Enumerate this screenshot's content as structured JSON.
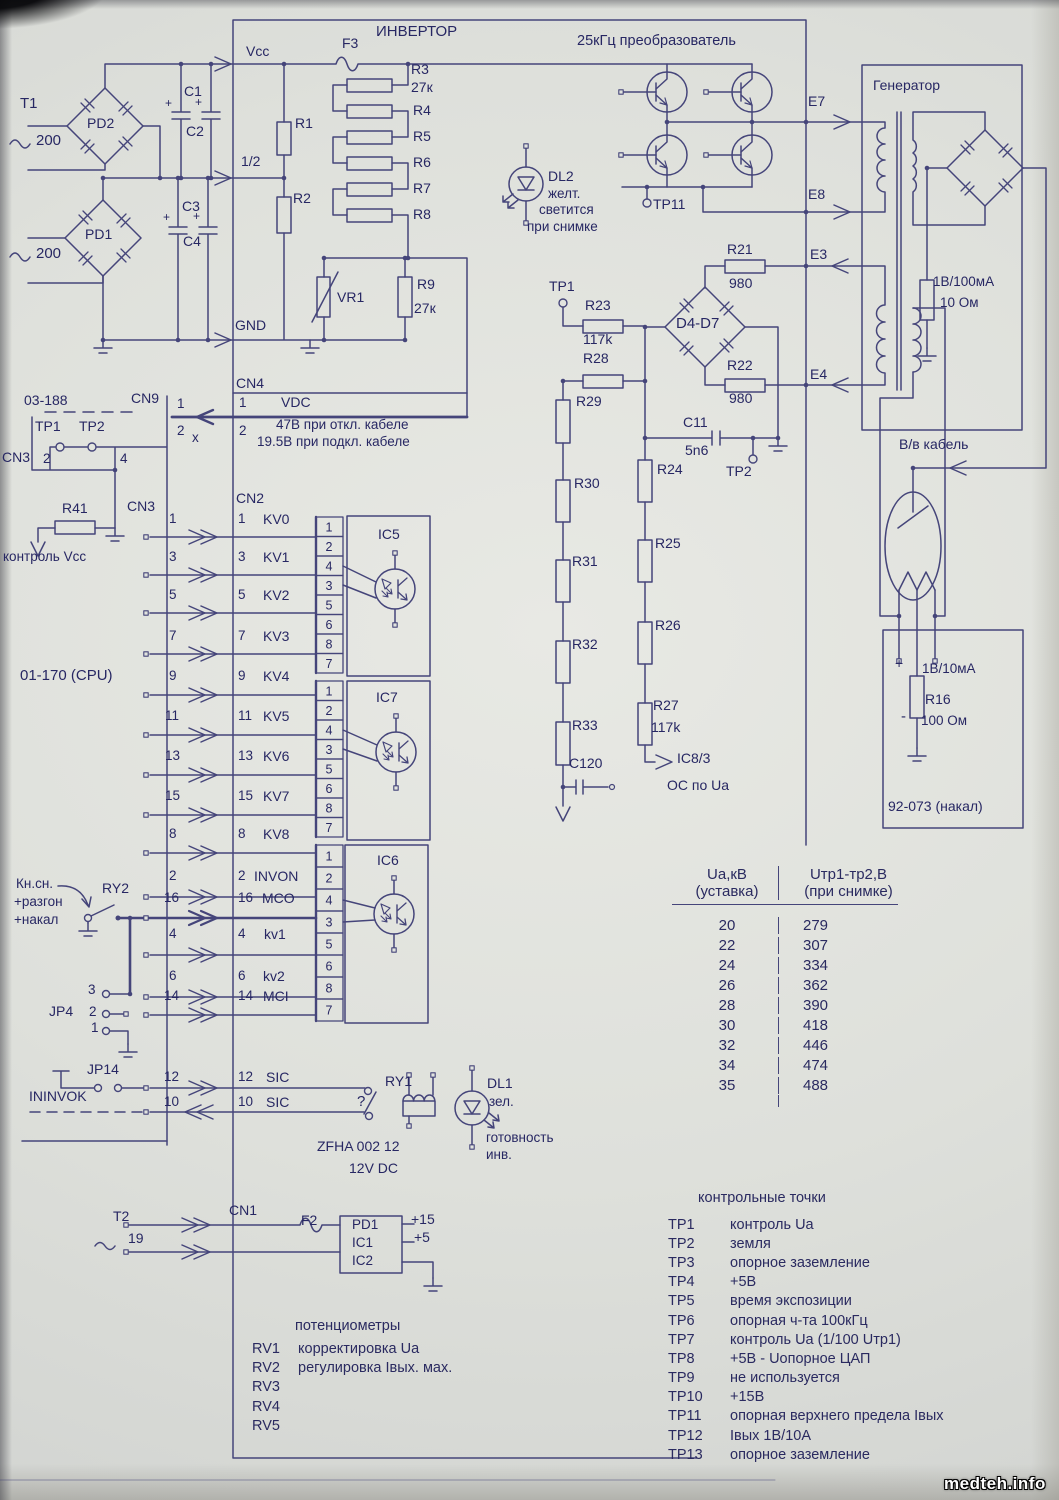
{
  "watermark": "medteh.info",
  "colors": {
    "ink": "#45457a",
    "text": "#272763",
    "paper": "#dee0db"
  },
  "opto_pin_sequence": [
    "1",
    "2",
    "4",
    "3",
    "5",
    "6",
    "8",
    "7"
  ],
  "table": {
    "h1a": "Ua,кВ",
    "h1b": "(уставка)",
    "h2a": "Uтр1-тр2,В",
    "h2b": "(при снимке)",
    "rows": [
      [
        "20",
        "279"
      ],
      [
        "22",
        "307"
      ],
      [
        "24",
        "334"
      ],
      [
        "26",
        "362"
      ],
      [
        "28",
        "390"
      ],
      [
        "30",
        "418"
      ],
      [
        "32",
        "446"
      ],
      [
        "34",
        "474"
      ],
      [
        "35",
        "488"
      ]
    ]
  },
  "test_points": {
    "title": "контрольные точки",
    "items": [
      [
        "TP1",
        "контроль Ua"
      ],
      [
        "TP2",
        "земля"
      ],
      [
        "TP3",
        "опорное заземление"
      ],
      [
        "TP4",
        "+5В"
      ],
      [
        "TP5",
        "время экспозиции"
      ],
      [
        "TP6",
        "опорная ч-та 100кГц"
      ],
      [
        "TP7",
        "контроль Ua (1/100 Uтр1)"
      ],
      [
        "TP8",
        "+5В - Uопорное ЦАП"
      ],
      [
        "TP9",
        "не используется"
      ],
      [
        "TP10",
        "+15В"
      ],
      [
        "TP11",
        "опорная верхнего предела Iвых"
      ],
      [
        "TP12",
        "Iвых 1В/10А"
      ],
      [
        "TP13",
        "опорное заземление"
      ]
    ]
  },
  "potentiometers": {
    "title": "потенциометры",
    "items": [
      [
        "RV1",
        "корректировка Ua"
      ],
      [
        "RV2",
        "регулировка Iвых. мах."
      ],
      [
        "RV3",
        ""
      ],
      [
        "RV4",
        ""
      ],
      [
        "RV5",
        ""
      ]
    ]
  },
  "labels": [
    {
      "n": "t1-label",
      "t": "T1",
      "x": 20,
      "y": 96,
      "s": 15
    },
    {
      "n": "ac1-value",
      "t": "200",
      "x": 36,
      "y": 133,
      "s": 15
    },
    {
      "n": "ac2-value",
      "t": "200",
      "x": 36,
      "y": 246,
      "s": 15
    },
    {
      "n": "pd2-label",
      "t": "PD2",
      "x": 87,
      "y": 116,
      "s": 14
    },
    {
      "n": "pd1-label",
      "t": "PD1",
      "x": 85,
      "y": 227,
      "s": 14
    },
    {
      "n": "c1-label",
      "t": "C1",
      "x": 184,
      "y": 84,
      "s": 14
    },
    {
      "n": "c2-label",
      "t": "C2",
      "x": 186,
      "y": 124,
      "s": 14
    },
    {
      "n": "c3-label",
      "t": "C3",
      "x": 182,
      "y": 199,
      "s": 14
    },
    {
      "n": "c4-label",
      "t": "C4",
      "x": 183,
      "y": 234,
      "s": 14
    },
    {
      "n": "c1-plus",
      "t": "+",
      "x": 165,
      "y": 97,
      "s": 12
    },
    {
      "n": "c2-plus",
      "t": "+",
      "x": 195,
      "y": 96,
      "s": 12
    },
    {
      "n": "c3-plus",
      "t": "+",
      "x": 163,
      "y": 211,
      "s": 12
    },
    {
      "n": "c4-plus",
      "t": "+",
      "x": 193,
      "y": 210,
      "s": 12
    },
    {
      "n": "vcc-label",
      "t": "Vcc",
      "x": 246,
      "y": 44,
      "s": 14
    },
    {
      "n": "half-label",
      "t": "1/2",
      "x": 241,
      "y": 154,
      "s": 14
    },
    {
      "n": "gnd-label",
      "t": "GND",
      "x": 235,
      "y": 318,
      "s": 14
    },
    {
      "n": "inverter-title",
      "t": "ИНВЕРТОР",
      "x": 376,
      "y": 24,
      "s": 15
    },
    {
      "n": "f3-label",
      "t": "F3",
      "x": 342,
      "y": 36,
      "s": 14
    },
    {
      "n": "r3-label",
      "t": "R3",
      "x": 411,
      "y": 62,
      "s": 14
    },
    {
      "n": "r3-value",
      "t": "27к",
      "x": 411,
      "y": 80,
      "s": 14
    },
    {
      "n": "r4-label",
      "t": "R4",
      "x": 413,
      "y": 103,
      "s": 14
    },
    {
      "n": "r5-label",
      "t": "R5",
      "x": 413,
      "y": 129,
      "s": 14
    },
    {
      "n": "r6-label",
      "t": "R6",
      "x": 413,
      "y": 155,
      "s": 14
    },
    {
      "n": "r7-label",
      "t": "R7",
      "x": 413,
      "y": 181,
      "s": 14
    },
    {
      "n": "r8-label",
      "t": "R8",
      "x": 413,
      "y": 207,
      "s": 14
    },
    {
      "n": "r1-label",
      "t": "R1",
      "x": 295,
      "y": 116,
      "s": 14
    },
    {
      "n": "r2-label",
      "t": "R2",
      "x": 293,
      "y": 191,
      "s": 14
    },
    {
      "n": "vr1-label",
      "t": "VR1",
      "x": 337,
      "y": 290,
      "s": 14
    },
    {
      "n": "r9-label",
      "t": "R9",
      "x": 417,
      "y": 277,
      "s": 14
    },
    {
      "n": "r9-value",
      "t": "27к",
      "x": 414,
      "y": 301,
      "s": 14
    },
    {
      "n": "dl2-label",
      "t": "DL2",
      "x": 548,
      "y": 169,
      "s": 14
    },
    {
      "n": "dl2-color",
      "t": "желт.",
      "x": 548,
      "y": 187
    },
    {
      "n": "dl2-note-1",
      "t": "светится",
      "x": 539,
      "y": 203
    },
    {
      "n": "dl2-note-2",
      "t": "при снимке",
      "x": 527,
      "y": 220
    },
    {
      "n": "converter-title",
      "t": "25кГц преобразователь",
      "x": 577,
      "y": 34,
      "s": 14.5
    },
    {
      "n": "tp11-label",
      "t": "TP11",
      "x": 653,
      "y": 197,
      "s": 14
    },
    {
      "n": "e7-label",
      "t": "E7",
      "x": 808,
      "y": 94,
      "s": 14
    },
    {
      "n": "e8-label",
      "t": "E8",
      "x": 808,
      "y": 187,
      "s": 14
    },
    {
      "n": "e3-label",
      "t": "E3",
      "x": 810,
      "y": 247,
      "s": 14
    },
    {
      "n": "e4-label",
      "t": "E4",
      "x": 810,
      "y": 367,
      "s": 14
    },
    {
      "n": "generator-title",
      "t": "Генератор",
      "x": 873,
      "y": 78,
      "s": 14
    },
    {
      "n": "r21-label",
      "t": "R21",
      "x": 727,
      "y": 242,
      "s": 14
    },
    {
      "n": "r21-value",
      "t": "980",
      "x": 729,
      "y": 276,
      "s": 14
    },
    {
      "n": "r22-label",
      "t": "R22",
      "x": 727,
      "y": 358,
      "s": 14
    },
    {
      "n": "r22-value",
      "t": "980",
      "x": 729,
      "y": 391,
      "s": 14
    },
    {
      "n": "d4d7-label",
      "t": "D4-D7",
      "x": 676,
      "y": 316,
      "s": 15
    },
    {
      "n": "tp1-mid-label",
      "t": "TP1",
      "x": 549,
      "y": 279,
      "s": 14
    },
    {
      "n": "r23-label",
      "t": "R23",
      "x": 585,
      "y": 298,
      "s": 14
    },
    {
      "n": "r23-value",
      "t": "117k",
      "x": 583,
      "y": 332,
      "s": 14
    },
    {
      "n": "r28-label",
      "t": "R28",
      "x": 583,
      "y": 351,
      "s": 14
    },
    {
      "n": "c11-label",
      "t": "C11",
      "x": 683,
      "y": 415,
      "s": 14
    },
    {
      "n": "c11-value",
      "t": "5n6",
      "x": 685,
      "y": 443,
      "s": 14
    },
    {
      "n": "tp2-mid-label",
      "t": "TP2",
      "x": 726,
      "y": 464,
      "s": 14
    },
    {
      "n": "r29-label",
      "t": "R29",
      "x": 576,
      "y": 394,
      "s": 14
    },
    {
      "n": "r30-label",
      "t": "R30",
      "x": 574,
      "y": 476,
      "s": 14
    },
    {
      "n": "r31-label",
      "t": "R31",
      "x": 572,
      "y": 554,
      "s": 14
    },
    {
      "n": "r32-label",
      "t": "R32",
      "x": 572,
      "y": 637,
      "s": 14
    },
    {
      "n": "r33-label",
      "t": "R33",
      "x": 572,
      "y": 718,
      "s": 14
    },
    {
      "n": "c120-label",
      "t": "C120",
      "x": 569,
      "y": 756,
      "s": 14
    },
    {
      "n": "r24-label",
      "t": "R24",
      "x": 657,
      "y": 462,
      "s": 14
    },
    {
      "n": "r25-label",
      "t": "R25",
      "x": 655,
      "y": 536,
      "s": 14
    },
    {
      "n": "r26-label",
      "t": "R26",
      "x": 655,
      "y": 618,
      "s": 14
    },
    {
      "n": "r27-label",
      "t": "R27",
      "x": 653,
      "y": 698,
      "s": 14
    },
    {
      "n": "r27-value",
      "t": "117k",
      "x": 651,
      "y": 720,
      "s": 14
    },
    {
      "n": "ic8-label",
      "t": "IC8/3",
      "x": 677,
      "y": 751,
      "s": 14
    },
    {
      "n": "os-ua-label",
      "t": "ОС по Ua",
      "x": 667,
      "y": 778,
      "s": 14
    },
    {
      "n": "board-03-188",
      "t": "03-188",
      "x": 24,
      "y": 393,
      "s": 14
    },
    {
      "n": "cn9-label",
      "t": "CN9",
      "x": 131,
      "y": 391,
      "s": 14
    },
    {
      "n": "cn9-pin1",
      "t": "1",
      "x": 177,
      "y": 397
    },
    {
      "n": "cn9-pin2",
      "t": "2",
      "x": 177,
      "y": 424
    },
    {
      "n": "cn9-nc",
      "t": "x",
      "x": 192,
      "y": 431
    },
    {
      "n": "tp1-left-label",
      "t": "TP1",
      "x": 35,
      "y": 419,
      "s": 14
    },
    {
      "n": "tp2-left-label",
      "t": "TP2",
      "x": 79,
      "y": 419,
      "s": 14
    },
    {
      "n": "cn3-label",
      "t": "CN3",
      "x": 2,
      "y": 450,
      "s": 14
    },
    {
      "n": "cn3-pin2",
      "t": "2",
      "x": 43,
      "y": 452
    },
    {
      "n": "cn3-pin4",
      "t": "4",
      "x": 120,
      "y": 452
    },
    {
      "n": "r41-label",
      "t": "R41",
      "x": 62,
      "y": 501,
      "s": 14
    },
    {
      "n": "cn3b-label",
      "t": "CN3",
      "x": 127,
      "y": 499,
      "s": 14
    },
    {
      "n": "kontrol-vcc-label",
      "t": "контроль Vcc",
      "x": 3,
      "y": 550
    },
    {
      "n": "cn4-label",
      "t": "CN4",
      "x": 236,
      "y": 376,
      "s": 14
    },
    {
      "n": "cn4-pin1",
      "t": "1",
      "x": 239,
      "y": 396
    },
    {
      "n": "vdc-label",
      "t": "VDC",
      "x": 281,
      "y": 395,
      "s": 14
    },
    {
      "n": "cn4-pin2",
      "t": "2",
      "x": 239,
      "y": 424
    },
    {
      "n": "cn4-note-1",
      "t": "47В при откл. кабеле",
      "x": 276,
      "y": 418
    },
    {
      "n": "cn4-note-2",
      "t": "19.5В при подкл. кабеле",
      "x": 257,
      "y": 435
    },
    {
      "n": "cn2-label",
      "t": "CN2",
      "x": 236,
      "y": 491,
      "s": 14
    },
    {
      "n": "cpu-label",
      "t": "01-170 (CPU)",
      "x": 20,
      "y": 668,
      "s": 15
    },
    {
      "n": "cpu-pin",
      "t": "1",
      "x": 169,
      "y": 512
    },
    {
      "n": "cpu-pin",
      "t": "3",
      "x": 169,
      "y": 550
    },
    {
      "n": "cpu-pin",
      "t": "5",
      "x": 169,
      "y": 588
    },
    {
      "n": "cpu-pin",
      "t": "7",
      "x": 169,
      "y": 629
    },
    {
      "n": "cpu-pin",
      "t": "9",
      "x": 169,
      "y": 669
    },
    {
      "n": "cpu-pin",
      "t": "11",
      "x": 165,
      "y": 709
    },
    {
      "n": "cpu-pin",
      "t": "13",
      "x": 165,
      "y": 749
    },
    {
      "n": "cpu-pin",
      "t": "15",
      "x": 165,
      "y": 789
    },
    {
      "n": "cpu-pin",
      "t": "8",
      "x": 169,
      "y": 827
    },
    {
      "n": "cpu-pin",
      "t": "2",
      "x": 169,
      "y": 869
    },
    {
      "n": "cpu-pin",
      "t": "16",
      "x": 164,
      "y": 891
    },
    {
      "n": "cpu-pin",
      "t": "4",
      "x": 169,
      "y": 927
    },
    {
      "n": "cpu-pin",
      "t": "6",
      "x": 169,
      "y": 969
    },
    {
      "n": "cpu-pin",
      "t": "14",
      "x": 164,
      "y": 989
    },
    {
      "n": "cpu-pin",
      "t": "12",
      "x": 164,
      "y": 1070
    },
    {
      "n": "cpu-pin",
      "t": "10",
      "x": 164,
      "y": 1095
    },
    {
      "n": "cn2-pin",
      "t": "1",
      "x": 238,
      "y": 512
    },
    {
      "n": "cn2-pin",
      "t": "3",
      "x": 238,
      "y": 550
    },
    {
      "n": "cn2-pin",
      "t": "5",
      "x": 238,
      "y": 588
    },
    {
      "n": "cn2-pin",
      "t": "7",
      "x": 238,
      "y": 629
    },
    {
      "n": "cn2-pin",
      "t": "9",
      "x": 238,
      "y": 669
    },
    {
      "n": "cn2-pin",
      "t": "11",
      "x": 238,
      "y": 709
    },
    {
      "n": "cn2-pin",
      "t": "13",
      "x": 238,
      "y": 749
    },
    {
      "n": "cn2-pin",
      "t": "15",
      "x": 238,
      "y": 789
    },
    {
      "n": "cn2-pin",
      "t": "8",
      "x": 238,
      "y": 827
    },
    {
      "n": "cn2-pin",
      "t": "2",
      "x": 238,
      "y": 869
    },
    {
      "n": "cn2-pin",
      "t": "16",
      "x": 238,
      "y": 891
    },
    {
      "n": "cn2-pin",
      "t": "4",
      "x": 238,
      "y": 927
    },
    {
      "n": "cn2-pin",
      "t": "6",
      "x": 238,
      "y": 969
    },
    {
      "n": "cn2-pin",
      "t": "14",
      "x": 238,
      "y": 989
    },
    {
      "n": "cn2-pin",
      "t": "12",
      "x": 238,
      "y": 1070
    },
    {
      "n": "cn2-pin",
      "t": "10",
      "x": 238,
      "y": 1095
    },
    {
      "n": "signal-kv0",
      "t": "KV0",
      "x": 263,
      "y": 512,
      "s": 14
    },
    {
      "n": "signal-kv1",
      "t": "KV1",
      "x": 263,
      "y": 550,
      "s": 14
    },
    {
      "n": "signal-kv2",
      "t": "KV2",
      "x": 263,
      "y": 588,
      "s": 14
    },
    {
      "n": "signal-kv3",
      "t": "KV3",
      "x": 263,
      "y": 629,
      "s": 14
    },
    {
      "n": "signal-kv4",
      "t": "KV4",
      "x": 263,
      "y": 669,
      "s": 14
    },
    {
      "n": "signal-kv5",
      "t": "KV5",
      "x": 263,
      "y": 709,
      "s": 14
    },
    {
      "n": "signal-kv6",
      "t": "KV6",
      "x": 263,
      "y": 749,
      "s": 14
    },
    {
      "n": "signal-kv7",
      "t": "KV7",
      "x": 263,
      "y": 789,
      "s": 14
    },
    {
      "n": "signal-kv8",
      "t": "KV8",
      "x": 263,
      "y": 827,
      "s": 14
    },
    {
      "n": "signal-invon",
      "t": "INVON",
      "x": 254,
      "y": 869,
      "s": 14
    },
    {
      "n": "signal-mco",
      "t": "MCO",
      "x": 262,
      "y": 891,
      "s": 14
    },
    {
      "n": "signal-kv1-low",
      "t": "kv1",
      "x": 264,
      "y": 927,
      "s": 14
    },
    {
      "n": "signal-kv2-low",
      "t": "kv2",
      "x": 263,
      "y": 969,
      "s": 14
    },
    {
      "n": "signal-mci",
      "t": "MCI",
      "x": 263,
      "y": 989,
      "s": 14
    },
    {
      "n": "signal-sic-out",
      "t": "SIC",
      "x": 266,
      "y": 1070,
      "s": 14
    },
    {
      "n": "signal-sic-in",
      "t": "SIC",
      "x": 266,
      "y": 1095,
      "s": 14
    },
    {
      "n": "ic5-label",
      "t": "IC5",
      "x": 378,
      "y": 527,
      "s": 14
    },
    {
      "n": "ic7-label",
      "t": "IC7",
      "x": 376,
      "y": 690,
      "s": 14
    },
    {
      "n": "ic6-label",
      "t": "IC6",
      "x": 377,
      "y": 853,
      "s": 14
    },
    {
      "n": "kn-sn-note-1",
      "t": "Кн.сн.",
      "x": 16,
      "y": 877
    },
    {
      "n": "kn-sn-note-2",
      "t": "+разгон",
      "x": 14,
      "y": 895
    },
    {
      "n": "kn-sn-note-3",
      "t": "+накал",
      "x": 14,
      "y": 913
    },
    {
      "n": "ry2-label",
      "t": "RY2",
      "x": 102,
      "y": 881,
      "s": 14
    },
    {
      "n": "jp4-label",
      "t": "JP4",
      "x": 49,
      "y": 1004,
      "s": 14
    },
    {
      "n": "jp4-pin3",
      "t": "3",
      "x": 88,
      "y": 983
    },
    {
      "n": "jp4-pin2",
      "t": "2",
      "x": 89,
      "y": 1005
    },
    {
      "n": "jp4-pin1",
      "t": "1",
      "x": 91,
      "y": 1021
    },
    {
      "n": "jp14-label",
      "t": "JP14",
      "x": 87,
      "y": 1062,
      "s": 14
    },
    {
      "n": "ininvok-label",
      "t": "ININVOK",
      "x": 29,
      "y": 1089,
      "s": 14
    },
    {
      "n": "ry1-label",
      "t": "RY1",
      "x": 385,
      "y": 1074,
      "s": 14
    },
    {
      "n": "ry1-question",
      "t": "?",
      "x": 357,
      "y": 1094,
      "s": 15
    },
    {
      "n": "relay-type",
      "t": "ZFHA 002 12",
      "x": 317,
      "y": 1139,
      "s": 14
    },
    {
      "n": "relay-voltage",
      "t": "12V DC",
      "x": 349,
      "y": 1161,
      "s": 14
    },
    {
      "n": "dl1-label",
      "t": "DL1",
      "x": 487,
      "y": 1076,
      "s": 14
    },
    {
      "n": "dl1-color",
      "t": "зел.",
      "x": 489,
      "y": 1095
    },
    {
      "n": "dl1-note-1",
      "t": "готовность",
      "x": 486,
      "y": 1131
    },
    {
      "n": "dl1-note-2",
      "t": "инв.",
      "x": 486,
      "y": 1148
    },
    {
      "n": "t2-label",
      "t": "T2",
      "x": 113,
      "y": 1209,
      "s": 14
    },
    {
      "n": "ac3-value",
      "t": "19",
      "x": 128,
      "y": 1231,
      "s": 14
    },
    {
      "n": "cn1-label",
      "t": "CN1",
      "x": 229,
      "y": 1203,
      "s": 14
    },
    {
      "n": "f2-label",
      "t": "F2",
      "x": 301,
      "y": 1213,
      "s": 14
    },
    {
      "n": "psu-pd1",
      "t": "PD1",
      "x": 352,
      "y": 1218,
      "s": 13.5
    },
    {
      "n": "psu-ic1",
      "t": "IC1",
      "x": 352,
      "y": 1236,
      "s": 13.5
    },
    {
      "n": "psu-ic2",
      "t": "IC2",
      "x": 352,
      "y": 1254,
      "s": 13.5
    },
    {
      "n": "psu-p15",
      "t": "+15",
      "x": 411,
      "y": 1212,
      "s": 14
    },
    {
      "n": "psu-p5",
      "t": "+5",
      "x": 414,
      "y": 1230,
      "s": 14
    },
    {
      "n": "hv-cable-label",
      "t": "В/в кабель",
      "x": 899,
      "y": 437,
      "s": 14
    },
    {
      "n": "gen-shunt-value",
      "t": "1В/100мА",
      "x": 933,
      "y": 275
    },
    {
      "n": "gen-shunt-ohm",
      "t": "10 Ом",
      "x": 940,
      "y": 296
    },
    {
      "n": "tube-plus",
      "t": "+",
      "x": 895,
      "y": 656,
      "s": 14
    },
    {
      "n": "r16-spec",
      "t": "1В/10мА",
      "x": 922,
      "y": 662
    },
    {
      "n": "r16-label",
      "t": "R16",
      "x": 925,
      "y": 692,
      "s": 14
    },
    {
      "n": "tube-minus",
      "t": "-",
      "x": 901,
      "y": 709,
      "s": 15
    },
    {
      "n": "r16-value",
      "t": "100 Ом",
      "x": 921,
      "y": 714
    },
    {
      "n": "board-92-073",
      "t": "92-073 (накал)",
      "x": 888,
      "y": 799,
      "s": 14
    }
  ]
}
